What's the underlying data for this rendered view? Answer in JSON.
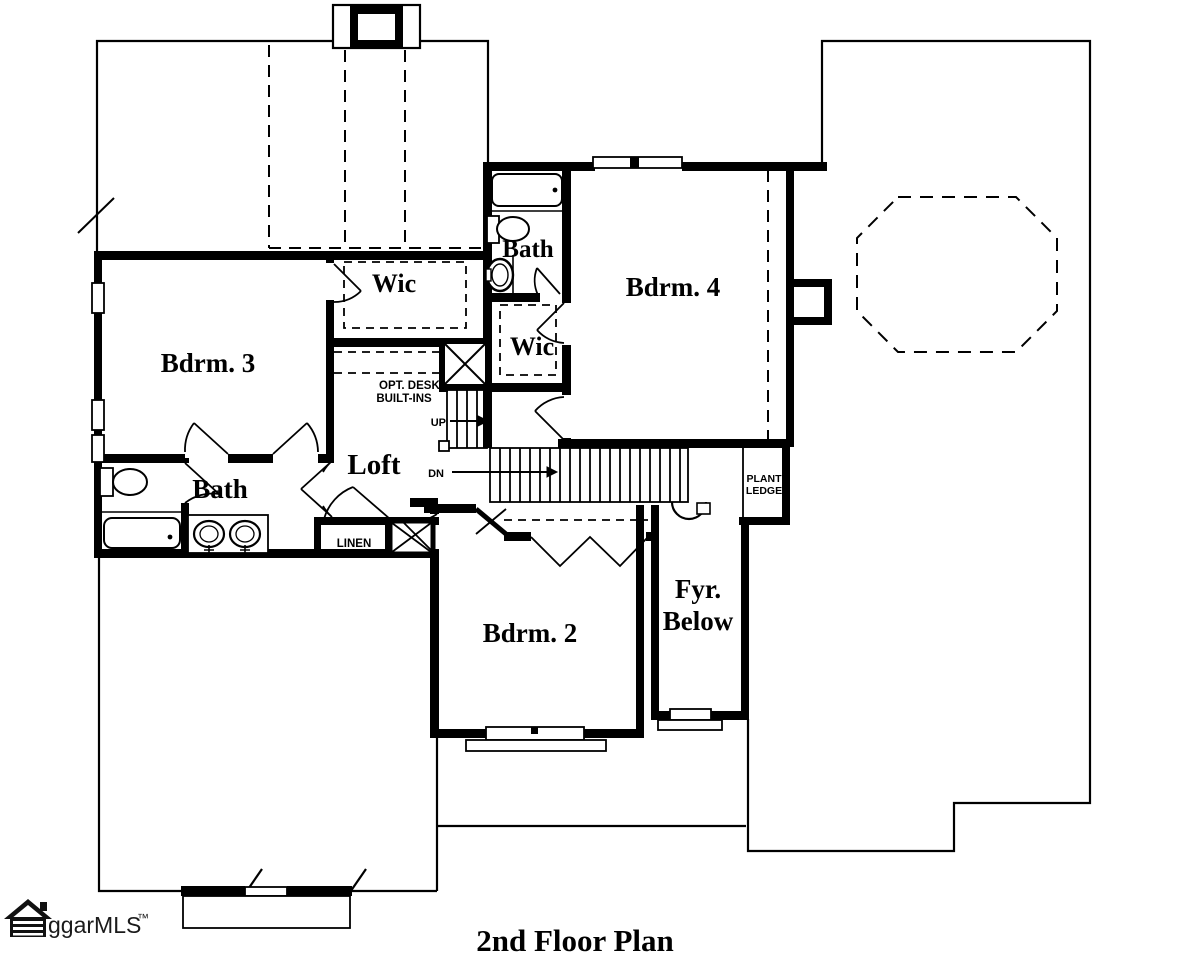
{
  "page": {
    "background": "#ffffff",
    "ink": "#000000"
  },
  "title": {
    "text": "2nd Floor Plan"
  },
  "watermark": {
    "logo": "house-icon",
    "text": "ggarMLS",
    "tm": "™"
  },
  "rooms": {
    "bdrm3": "Bdrm. 3",
    "bdrm4": "Bdrm. 4",
    "bdrm2": "Bdrm. 2",
    "loft": "Loft",
    "bath_upper": "Bath",
    "bath_lower": "Bath",
    "wic_left": "Wic",
    "wic_right": "Wic",
    "fyr_line1": "Fyr.",
    "fyr_line2": "Below"
  },
  "annotations": {
    "opt_desk_line1": "OPT. DESK/",
    "opt_desk_line2": "BUILT-INS",
    "up": "UP",
    "dn": "DN",
    "linen": "LINEN",
    "plant_line1": "PLANT",
    "plant_line2": "LEDGE"
  }
}
